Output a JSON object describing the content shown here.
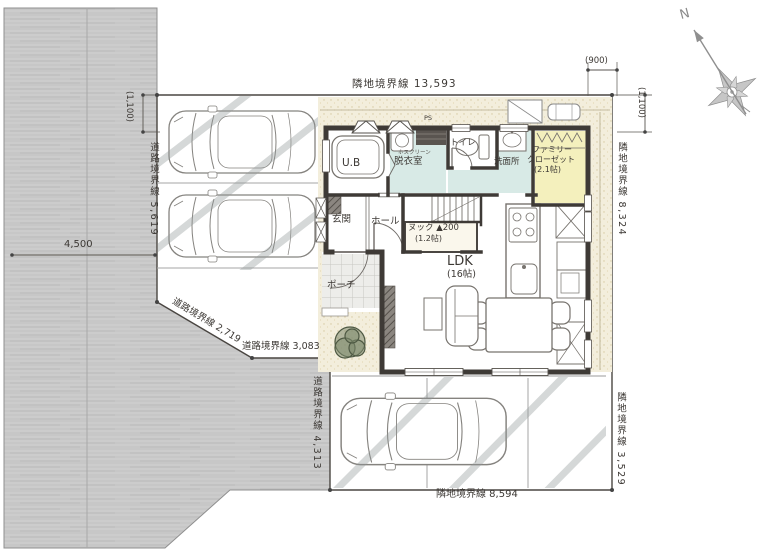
{
  "boundaries": {
    "top": "隣地境界線  13,593",
    "top_right_offset": "(900)",
    "right_upper_offset": "(1,100)",
    "left_offset": "(1,100)",
    "road_west": "道路境界線 5,619",
    "road_width": "4,500",
    "road_diagonal": "道路境界線  2,719",
    "road_south": "道路境界線  3,083",
    "road_west_lower": "道路境界線 4,313",
    "bottom": "隣地境界線  8,594",
    "right_lower": "隣地境界線 3,529",
    "right_upper": "隣地境界線 8,324"
  },
  "compass": {
    "north": "N"
  },
  "rooms": {
    "unit_bath": "U.B",
    "dressing_room": "脱衣室",
    "toilet": "トイレ",
    "washroom": "洗面所",
    "family_closet_line1": "ファミリー",
    "family_closet_line2": "クローゼット",
    "family_closet_size": "(2.1帖)",
    "entrance": "玄関",
    "hall": "ホール",
    "nook": "ヌック ▲200",
    "nook_size": "(1.2帖)",
    "ldk": "LDK",
    "ldk_size": "(16帖)",
    "porch": "ポーチ",
    "hosclean": "ホスクリーン",
    "pipe_space": "PS"
  },
  "colors": {
    "road": "#c8c8c8",
    "exterior_band": "#f3eedc",
    "wet_area_floor": "#d8eae6",
    "closet_floor": "#f4f0bd",
    "walls": "#3e3a36",
    "dimension_text": "#3c3834"
  }
}
